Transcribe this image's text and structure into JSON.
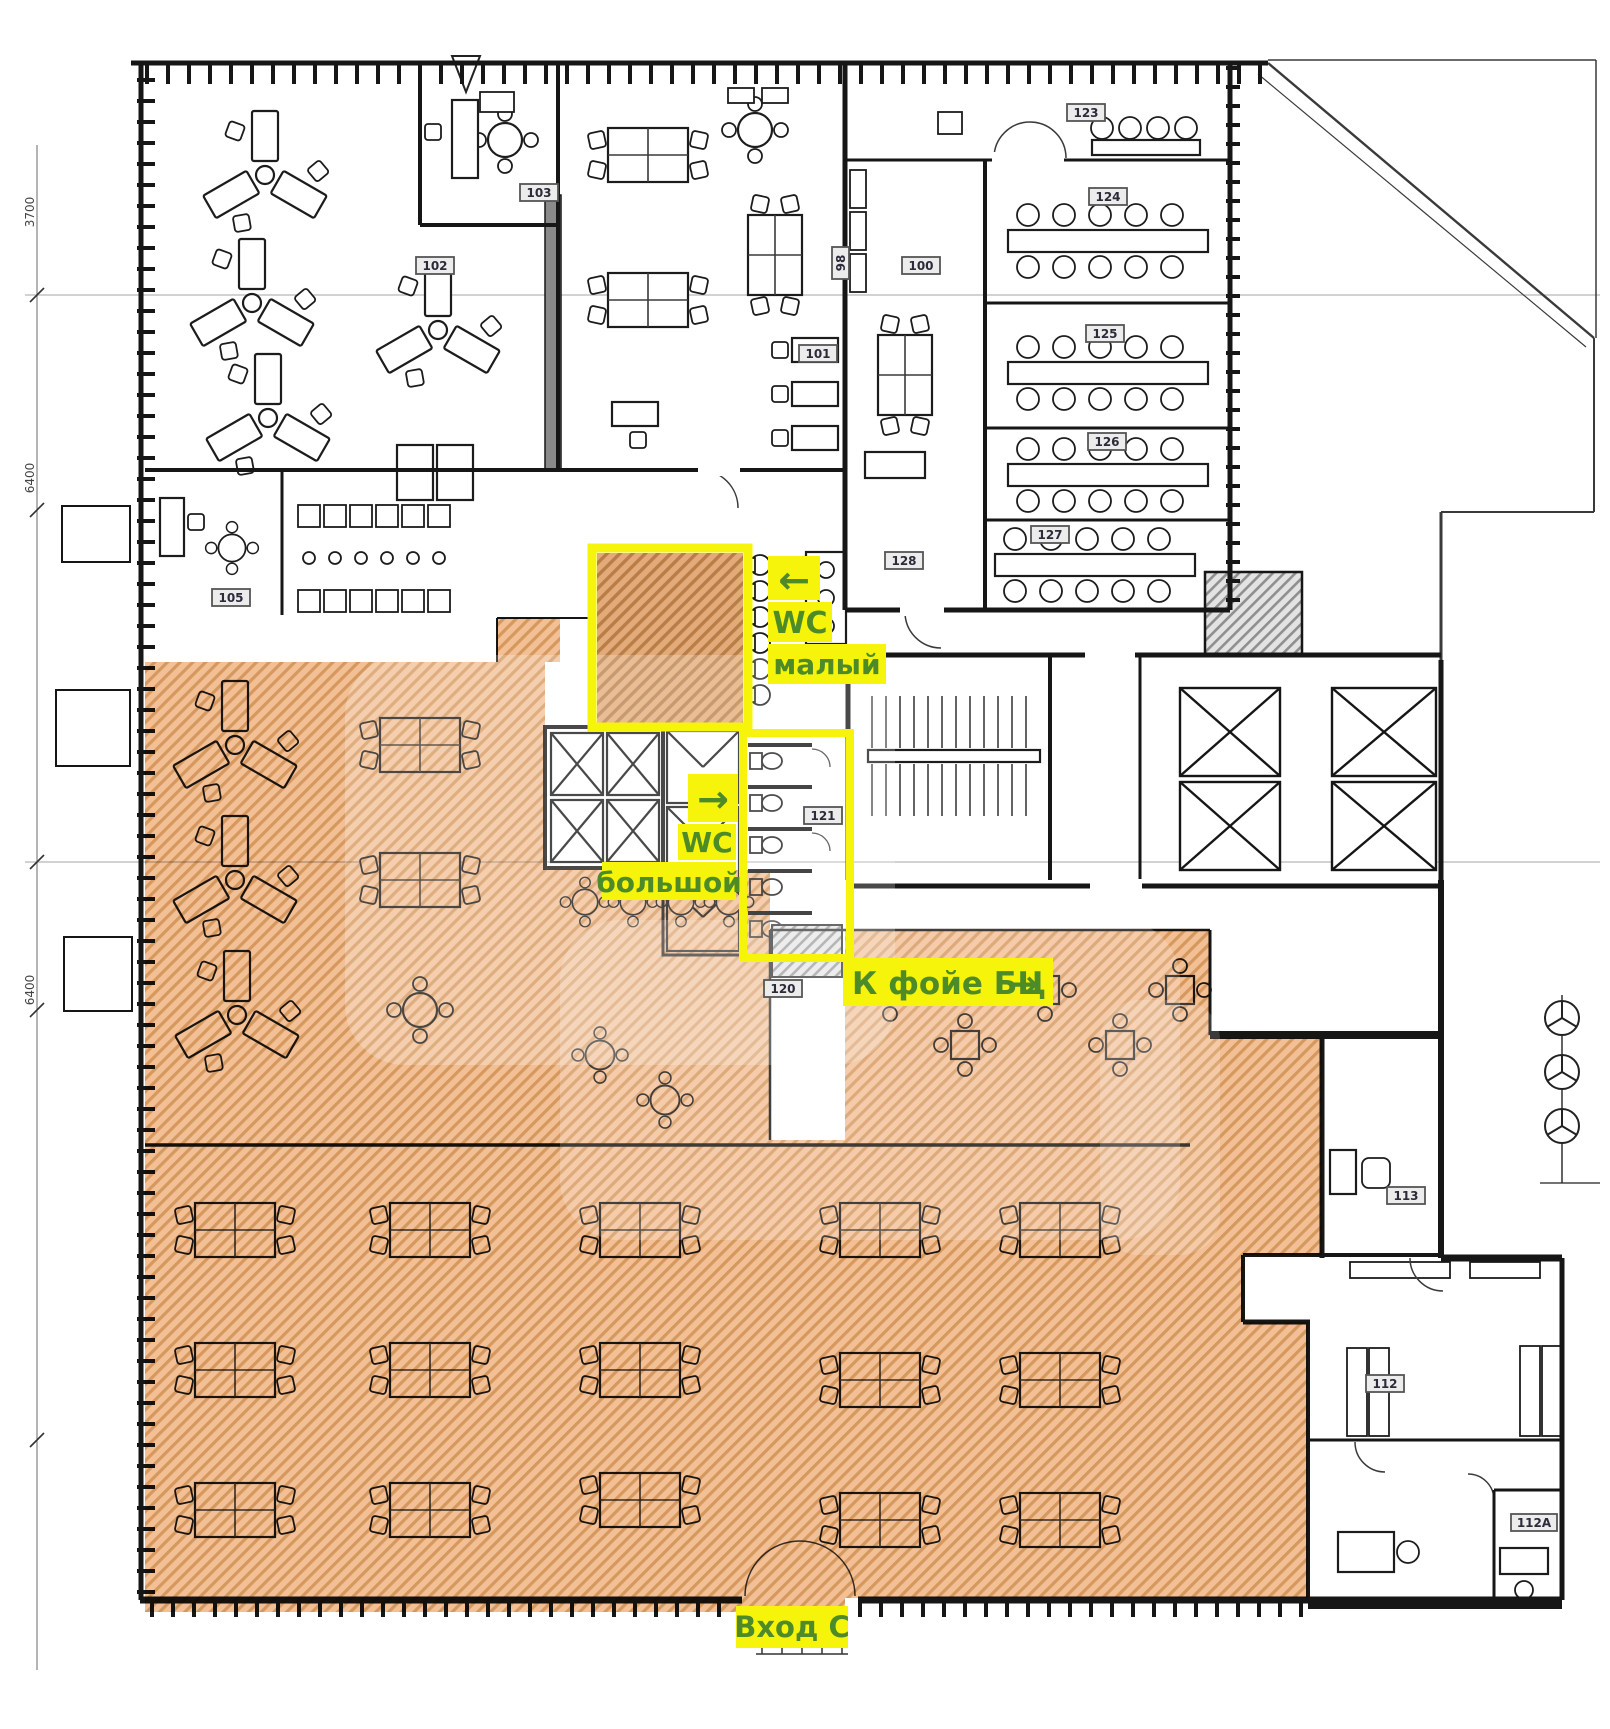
{
  "plan": {
    "highlight_labels": {
      "wc_small": {
        "arrow": "←",
        "line1": "WC",
        "line2": "малый"
      },
      "wc_large": {
        "arrow": "→",
        "line1": "WC",
        "line2": "большой"
      },
      "to_foyer": {
        "label": "К фойе БЦ",
        "arrow": "→"
      },
      "entrance": {
        "label": "Вход С"
      }
    },
    "room_numbers": [
      "102",
      "103",
      "105",
      "98",
      "100",
      "101",
      "123",
      "124",
      "125",
      "126",
      "127",
      "128",
      "121",
      "120",
      "113",
      "112",
      "112A"
    ],
    "dimension_labels": [
      "3700",
      "6400",
      "6400"
    ],
    "colors": {
      "highlight_area": "#f2b887",
      "highlight_hatch": "#cf8a48",
      "label_background": "#f6f40a",
      "label_text": "#4c8b28",
      "walls": "#161616"
    }
  }
}
